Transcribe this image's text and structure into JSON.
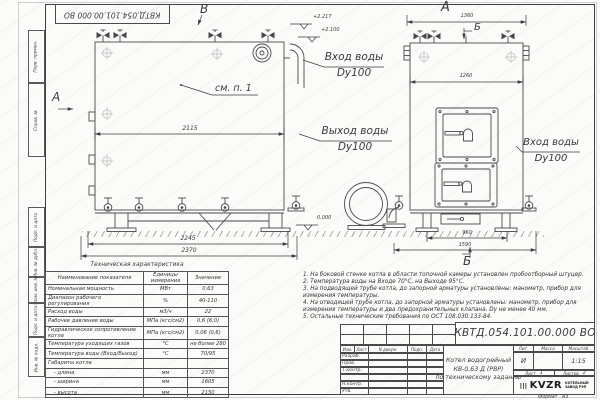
{
  "doc_number": "КВТД.054.101.00.000 ВО",
  "margin_labels": [
    "Перв. примен.",
    "Справ. №",
    "Подп. и дата",
    "Инв. № дубл.",
    "Взам. инв. №",
    "Подп. и дата",
    "Инв. № подл."
  ],
  "view_markers": {
    "top_b": "В",
    "side_a": "А",
    "front_title": "А",
    "section_b_top": "Б",
    "section_b_bottom": "Б"
  },
  "annotation_see": "см. п. 1",
  "elevations": {
    "top1": "+2.217",
    "top2": "+2.100",
    "zero": "0.000"
  },
  "pipe_labels": {
    "inlet_mid_1": "Вход воды",
    "inlet_mid_2": "Dy100",
    "outlet_1": "Выход воды",
    "outlet_2": "Dy100",
    "inlet_right_1": "Вход воды",
    "inlet_right_2": "Dy100"
  },
  "dimensions": {
    "side_width": "2115",
    "side_base": "2245",
    "side_overall": "2370",
    "front_top": "1360",
    "front_width": "1260",
    "front_legs": "960",
    "front_overall": "1590"
  },
  "spec_table": {
    "title": "Техническая характеристика",
    "headers": [
      "Наименование показателя",
      "Единицы измерения",
      "Значение"
    ],
    "rows": [
      [
        "Номинальная мощность",
        "МВт",
        "0,63"
      ],
      [
        "Диапазон рабочего регулирования",
        "%",
        "40-110"
      ],
      [
        "Расход воды",
        "м3/ч",
        "22"
      ],
      [
        "Рабочее давление воды",
        "МПа (кгс/см2)",
        "0,6 (6,0)"
      ],
      [
        "Гидравлическое сопротивление котла",
        "МПа (кгс/см2)",
        "0,06 (0,6)"
      ],
      [
        "Температура уходящих газов",
        "°С",
        "не более 280"
      ],
      [
        "Температура воды (Вход/Выход)",
        "°С",
        "70/95"
      ],
      [
        "Габариты котла",
        "",
        ""
      ],
      [
        "- длина",
        "мм",
        "2370"
      ],
      [
        "- ширина",
        "мм",
        "1605"
      ],
      [
        "- высота",
        "мм",
        "2150"
      ]
    ]
  },
  "notes": [
    "1. На боковой стенке котла в области топочной камеры установлен пробоотборный штуцер.",
    "2. Температура воды на Входе 70°С, на Выходе 95°С.",
    "3. На подводящей трубе котла, до запорной арматуры установлены: манометр, прибор для измерения температуры.",
    "4. На отводящей трубе котла, до запорной арматуры установлены: манометр, прибор для измерения температуры и два предохранительных клапана. Dу не менее 40 мм.",
    "5. Остальные технические требования по ОСТ 108.030.133-84."
  ],
  "title_block": {
    "cols": [
      "Изм.",
      "Лист",
      "N докум.",
      "Подп.",
      "Дата"
    ],
    "rows": [
      "Разраб.",
      "Пров.",
      "Т.контр.",
      "Н.контр.",
      "Утв."
    ],
    "product": [
      "Котел водогрейный",
      "КВ-0,63 Д (РВР)",
      "по техническому заданию"
    ],
    "lit_label": "Лит.",
    "mass_label": "Масса",
    "scale_label": "Масштаб",
    "lit": "И",
    "scale": "1:15",
    "sheet_label": "Лист",
    "sheet": "1",
    "sheets_label": "Листов",
    "sheets": "2",
    "logo": "KVZR",
    "org1": "КОТЕЛЬНЫЙ",
    "org2": "ЗАВОД РЭП",
    "format_label": "Формат",
    "format_value": "А3"
  }
}
